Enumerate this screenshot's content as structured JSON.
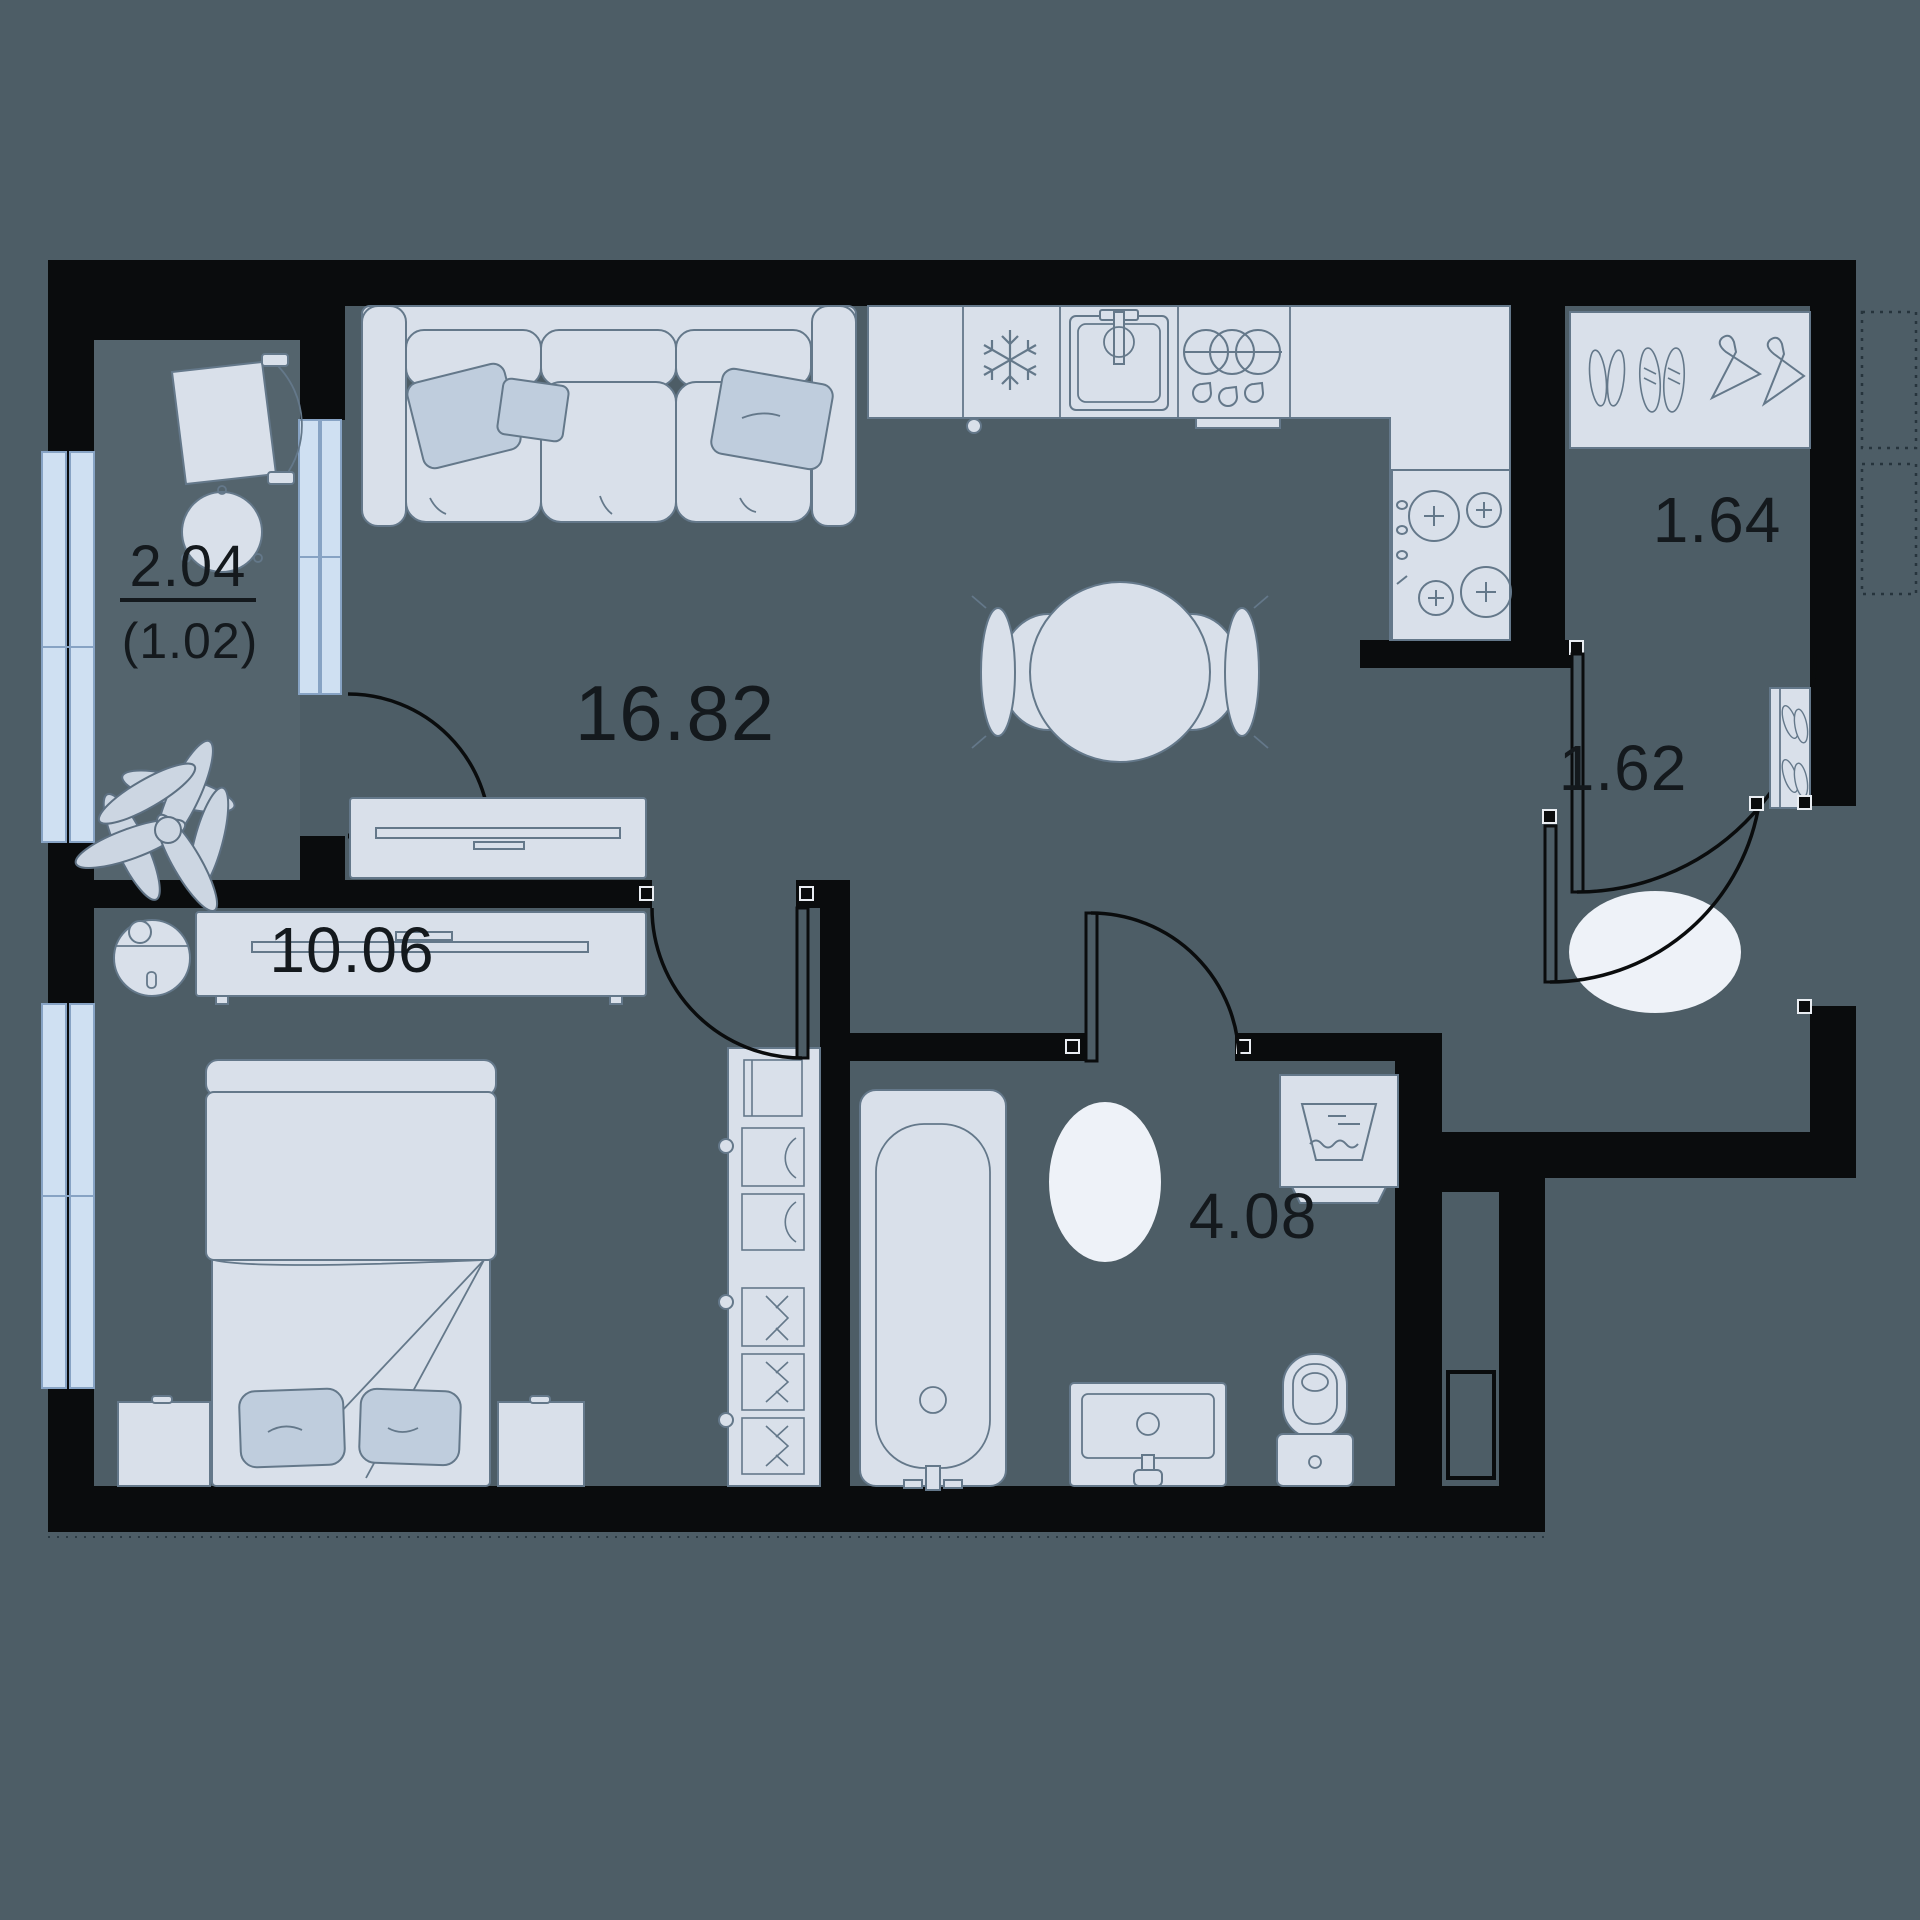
{
  "title": "apartment-floor-plan",
  "colors": {
    "background": "#4d5d66",
    "balcony_floor": "#54646d",
    "wall": "#0a0c0d",
    "furniture_fill": "#d9e0ea",
    "furniture_stroke": "#64788a",
    "pillow_fill": "#bfcddd",
    "window_fill": "#cfe0f2",
    "window_stroke": "#87a3c4",
    "rug_fill": "#eef2f8",
    "label_color": "#14191d"
  },
  "rooms": [
    {
      "name": "balcony",
      "area_label": "2.04",
      "secondary_area_label": "(1.02)"
    },
    {
      "name": "living-room-kitchen",
      "area_label": "16.82"
    },
    {
      "name": "closet",
      "area_label": "1.64"
    },
    {
      "name": "hallway",
      "area_label": "1.62"
    },
    {
      "name": "bedroom",
      "area_label": "10.06"
    },
    {
      "name": "bathroom",
      "area_label": "4.08"
    }
  ],
  "icons": [
    "fridge-snowflake-icon",
    "sink-faucet-icon",
    "oven-rings-icon",
    "stove-burners-icon",
    "washing-machine-icon",
    "shoes-icon",
    "hanger-icon",
    "plant-icon",
    "robot-vacuum-icon"
  ]
}
